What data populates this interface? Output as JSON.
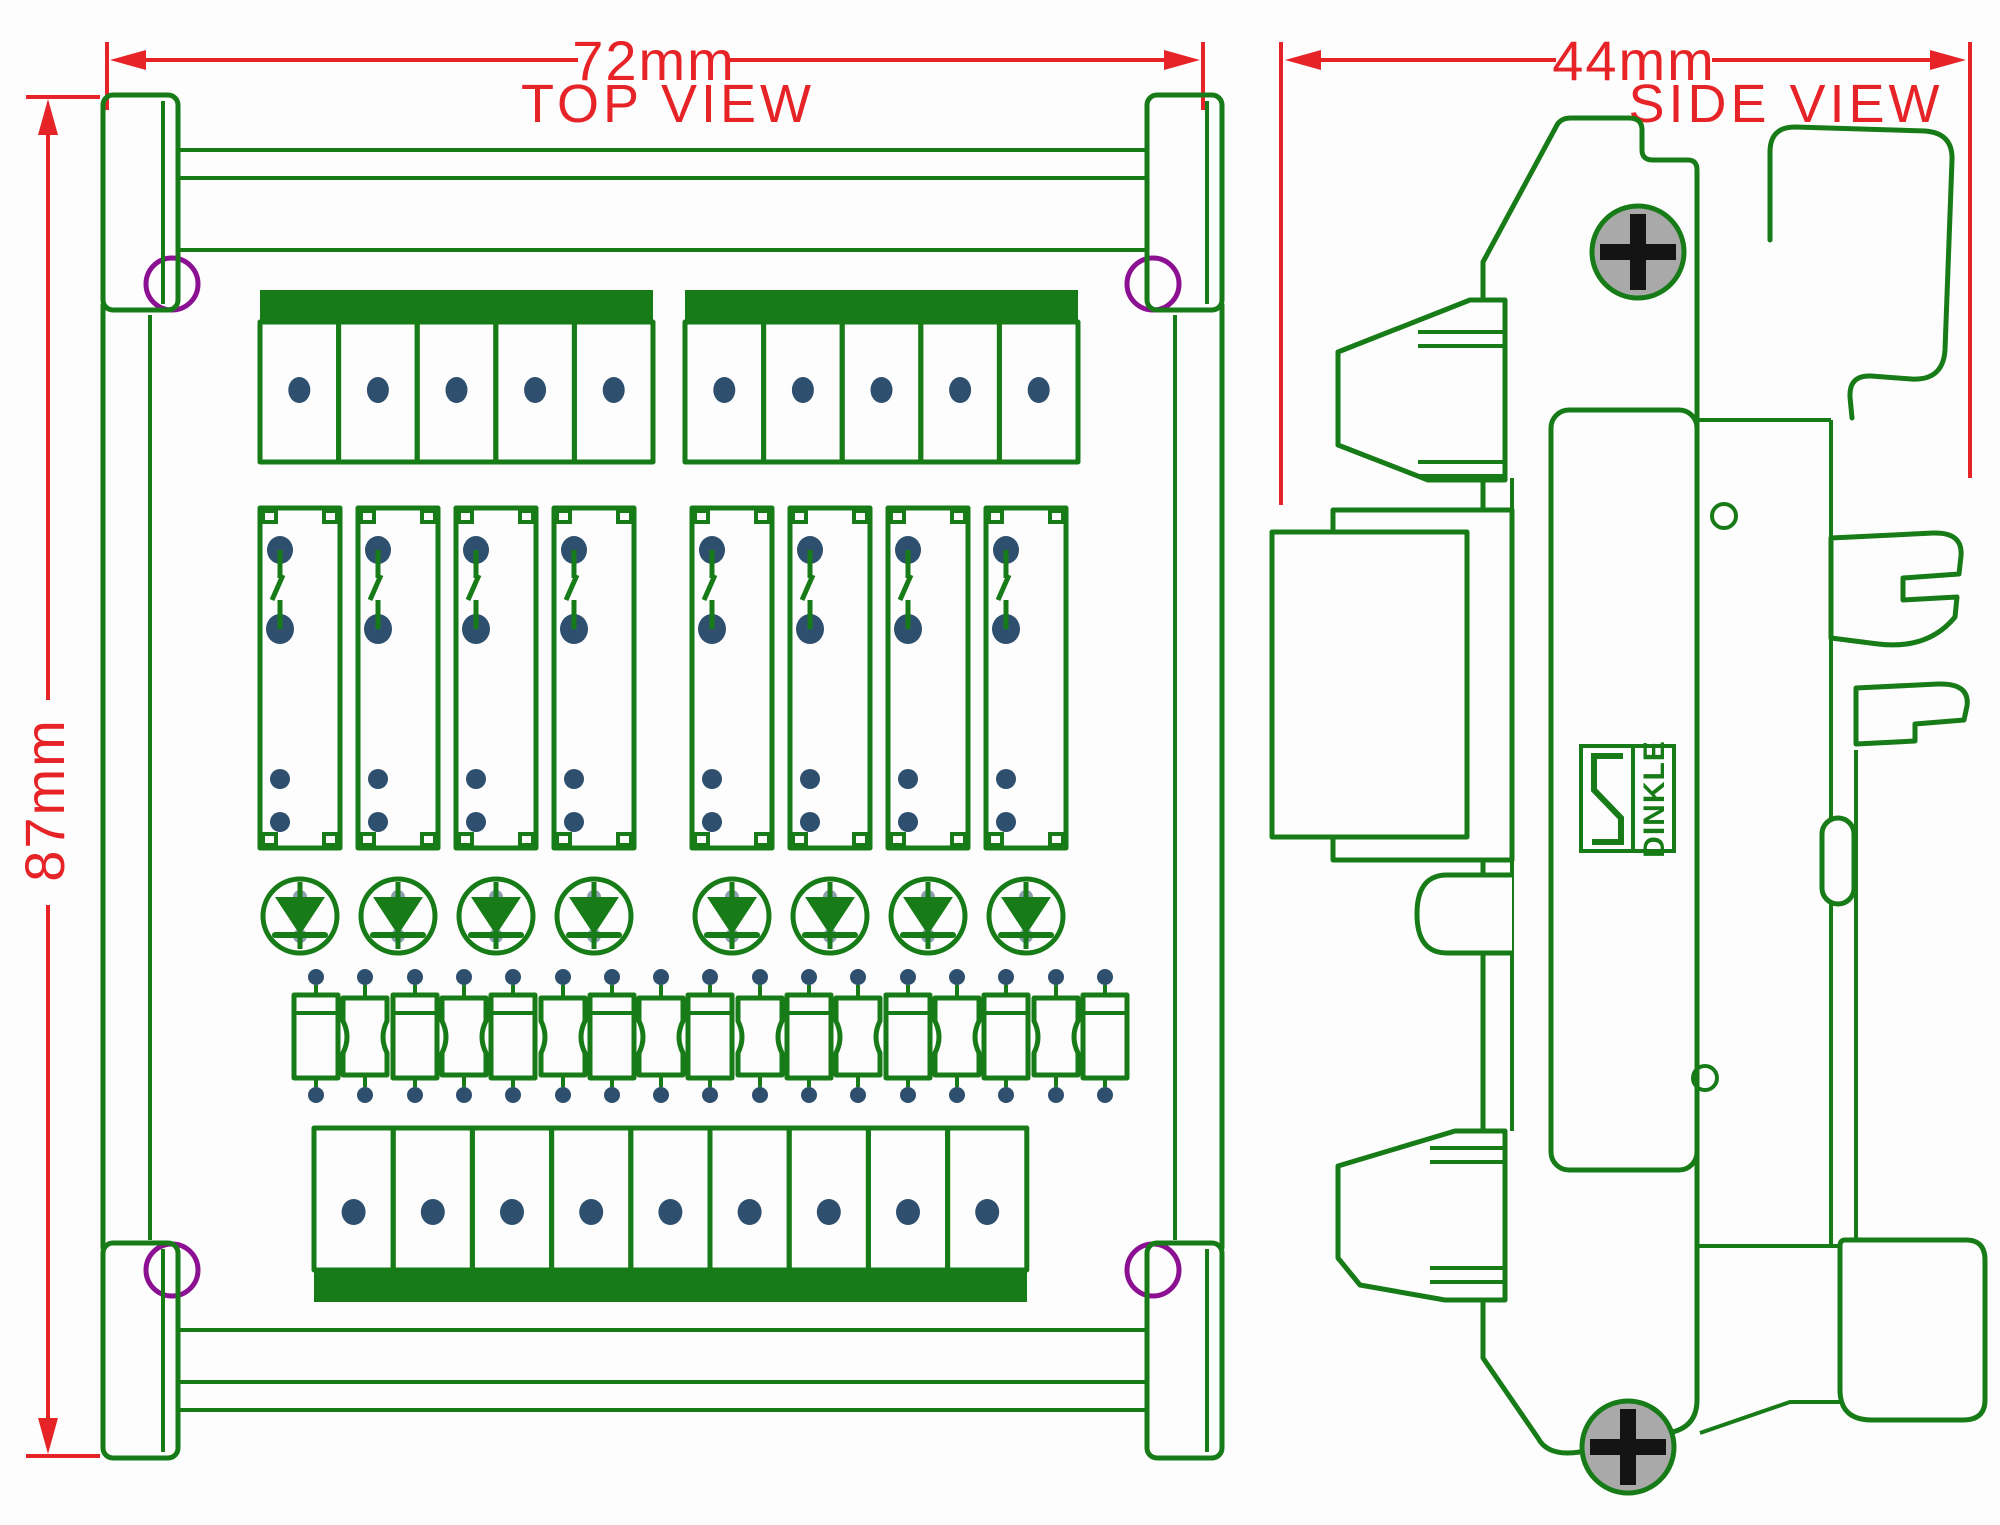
{
  "labels": {
    "top_view": "TOP VIEW",
    "side_view": "SIDE VIEW"
  },
  "dimensions": {
    "top_width": "72mm",
    "left_height": "87mm",
    "side_width": "44mm"
  },
  "brand": {
    "name": "DINKLE"
  },
  "colors": {
    "line_green": "#177c17",
    "dim_red": "#e62428",
    "hole_purple": "#8c1192",
    "pad_slate": "#2e4f6e",
    "screw_gray": "#a9a9a9",
    "cross_black": "#141414",
    "background": "#fdfdfd"
  },
  "components": {
    "relay_channels": 8,
    "input_terminal_cells": 10,
    "output_terminal_cells": 9,
    "indicator_diodes": 8,
    "resistor_elements": 17,
    "corner_mounting_holes": 4,
    "panel_screws": 2
  }
}
